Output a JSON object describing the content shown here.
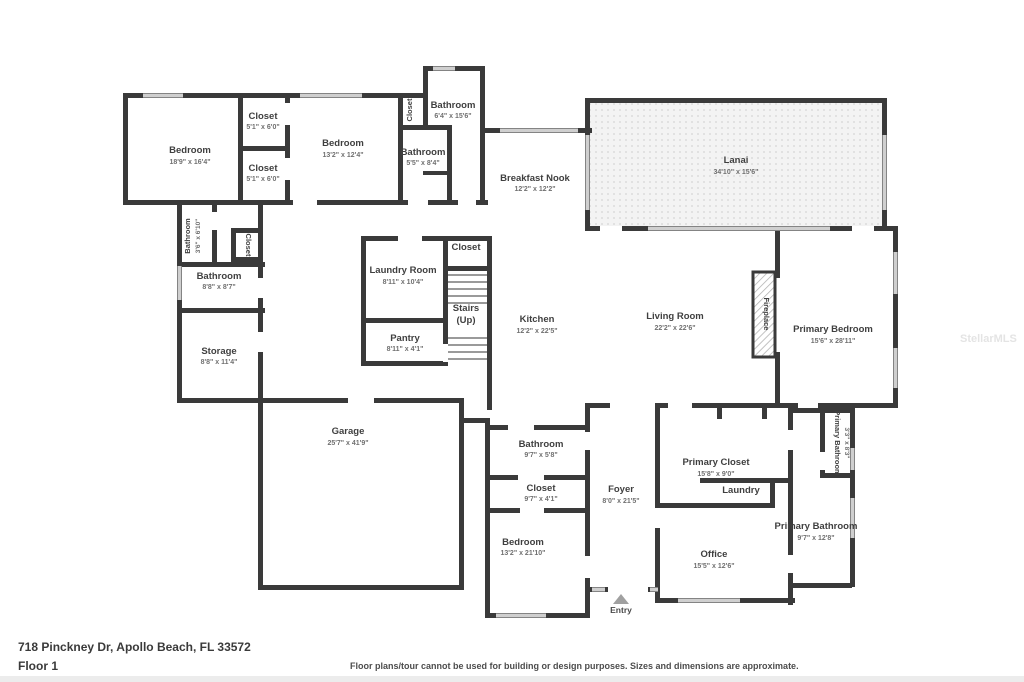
{
  "footer": {
    "address": "718 Pinckney Dr, Apollo Beach, FL 33572",
    "floor": "Floor 1",
    "disclaimer": "Floor plans/tour cannot be used for building or design purposes. Sizes and dimensions are approximate."
  },
  "watermark": "StellarMLS",
  "colors": {
    "wall": "#3a3a3a",
    "window": "#cfcfcf",
    "label": "#3f3f3f",
    "lanai_dot": "#dcdcdc"
  },
  "rooms": {
    "bedroom_left": {
      "name": "Bedroom",
      "dims": "18'9\" x 16'4\""
    },
    "closet_top_a": {
      "name": "Closet",
      "dims": "5'1\" x 6'0\""
    },
    "closet_top_b": {
      "name": "Closet",
      "dims": "5'1\" x 6'0\""
    },
    "bedroom_top": {
      "name": "Bedroom",
      "dims": "13'2\" x 12'4\""
    },
    "bathroom_top": {
      "name": "Bathroom",
      "dims": "6'4\" x 15'6\""
    },
    "closet_top_small": {
      "name": "Closet"
    },
    "bathroom_55": {
      "name": "Bathroom",
      "dims": "5'5\" x 8'4\""
    },
    "breakfast_nook": {
      "name": "Breakfast Nook",
      "dims": "12'2\" x 12'2\""
    },
    "lanai": {
      "name": "Lanai",
      "dims": "34'10\" x 15'6\""
    },
    "bathroom_left_small": {
      "name": "Bathroom",
      "dims": "3'6\" x 6'10\""
    },
    "closet_hall": {
      "name": "Closet"
    },
    "bathroom_88": {
      "name": "Bathroom",
      "dims": "8'8\" x 8'7\""
    },
    "storage": {
      "name": "Storage",
      "dims": "8'8\" x 11'4\""
    },
    "laundry_room": {
      "name": "Laundry Room",
      "dims": "8'11\" x 10'4\""
    },
    "closet_stairs": {
      "name": "Closet"
    },
    "stairs": {
      "name": "Stairs",
      "dims": "(Up)"
    },
    "pantry": {
      "name": "Pantry",
      "dims": "8'11\" x 4'1\""
    },
    "kitchen": {
      "name": "Kitchen",
      "dims": "12'2\" x 22'5\""
    },
    "living_room": {
      "name": "Living Room",
      "dims": "22'2\" x 22'6\""
    },
    "fireplace": {
      "name": "Fireplace"
    },
    "primary_bedroom": {
      "name": "Primary Bedroom",
      "dims": "15'6\" x 28'11\""
    },
    "garage": {
      "name": "Garage",
      "dims": "25'7\" x 41'9\""
    },
    "bathroom_97": {
      "name": "Bathroom",
      "dims": "9'7\" x 5'8\""
    },
    "closet_97": {
      "name": "Closet",
      "dims": "9'7\" x 4'1\""
    },
    "bedroom_bottom": {
      "name": "Bedroom",
      "dims": "13'2\" x 21'10\""
    },
    "foyer": {
      "name": "Foyer",
      "dims": "8'0\" x 21'5\""
    },
    "primary_closet": {
      "name": "Primary Closet",
      "dims": "15'8\" x 9'0\""
    },
    "laundry": {
      "name": "Laundry"
    },
    "office": {
      "name": "Office",
      "dims": "15'5\" x 12'6\""
    },
    "primary_bathroom_small": {
      "name": "Primary Bathroom",
      "dims": "3'3\" x 8'3\""
    },
    "primary_bathroom": {
      "name": "Primary Bathroom",
      "dims": "9'7\" x 12'8\""
    },
    "entry": {
      "name": "Entry"
    }
  }
}
